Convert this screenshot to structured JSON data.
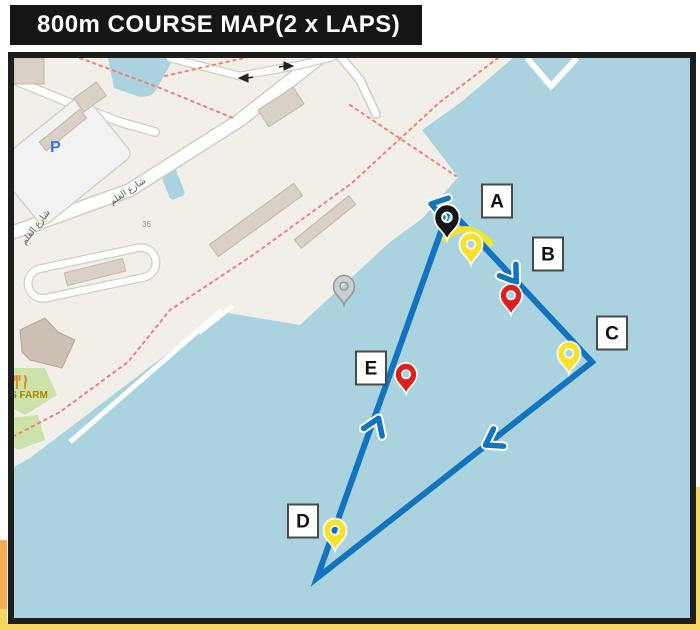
{
  "title": {
    "text": "800m COURSE MAP(2 x LAPS)"
  },
  "map_texts": {
    "parking": "P",
    "street_name_1": "شارع القلم",
    "street_name_2": "شارع القلم",
    "house_number": "36",
    "poi_farm": "S FARM"
  },
  "colors": {
    "water": "#aad3df",
    "land": "#f2efe9",
    "building": "#d9d0c7",
    "course_blue": "#1273bf",
    "marker_yellow": "#f5e32a",
    "marker_red": "#dd1f1f",
    "marker_black": "#15151a",
    "marker_gray": "#cdced2",
    "accent_orange": "#f6ab57",
    "accent_yellow": "#f5d75f",
    "frame": "#1d1d1b",
    "path_dotted_red": "#f08274"
  },
  "course": {
    "vertices": [
      [
        449,
        209
      ],
      [
        592,
        362
      ],
      [
        317,
        578
      ]
    ],
    "buoy_line_highlight": "M445,239 Q467,218 490,243",
    "labels": [
      {
        "id": "A",
        "x": 497,
        "y": 201
      },
      {
        "id": "B",
        "x": 548,
        "y": 254
      },
      {
        "id": "C",
        "x": 612,
        "y": 333
      },
      {
        "id": "D",
        "x": 303,
        "y": 521
      },
      {
        "id": "E",
        "x": 371,
        "y": 368
      }
    ],
    "pins": [
      {
        "id": "start-finish-pin",
        "color": "black",
        "x": 447,
        "y": 240,
        "scale": 1.15
      },
      {
        "id": "buoy-a-pin",
        "color": "yellow",
        "x": 471,
        "y": 265,
        "scale": 1.05
      },
      {
        "id": "buoy-b-pin",
        "color": "red",
        "x": 511,
        "y": 315,
        "scale": 1.0
      },
      {
        "id": "buoy-c-pin",
        "color": "yellow",
        "x": 569,
        "y": 374,
        "scale": 1.05
      },
      {
        "id": "buoy-d-pin",
        "color": "yellow",
        "x": 335,
        "y": 551,
        "scale": 1.05
      },
      {
        "id": "buoy-e-pin",
        "color": "red",
        "x": 406,
        "y": 394,
        "scale": 1.0
      },
      {
        "id": "poi-gray-pin",
        "color": "gray",
        "x": 344,
        "y": 305,
        "scale": 0.95
      }
    ],
    "chevrons": [
      {
        "id": "turn-top",
        "x": 435,
        "y": 205,
        "angle": 195
      },
      {
        "id": "dir-a-to-c",
        "x": 514,
        "y": 279,
        "angle": 55
      },
      {
        "id": "dir-c-to-d",
        "x": 489,
        "y": 443,
        "angle": 150
      },
      {
        "id": "dir-d-to-top",
        "x": 377,
        "y": 422,
        "angle": 292
      }
    ]
  }
}
